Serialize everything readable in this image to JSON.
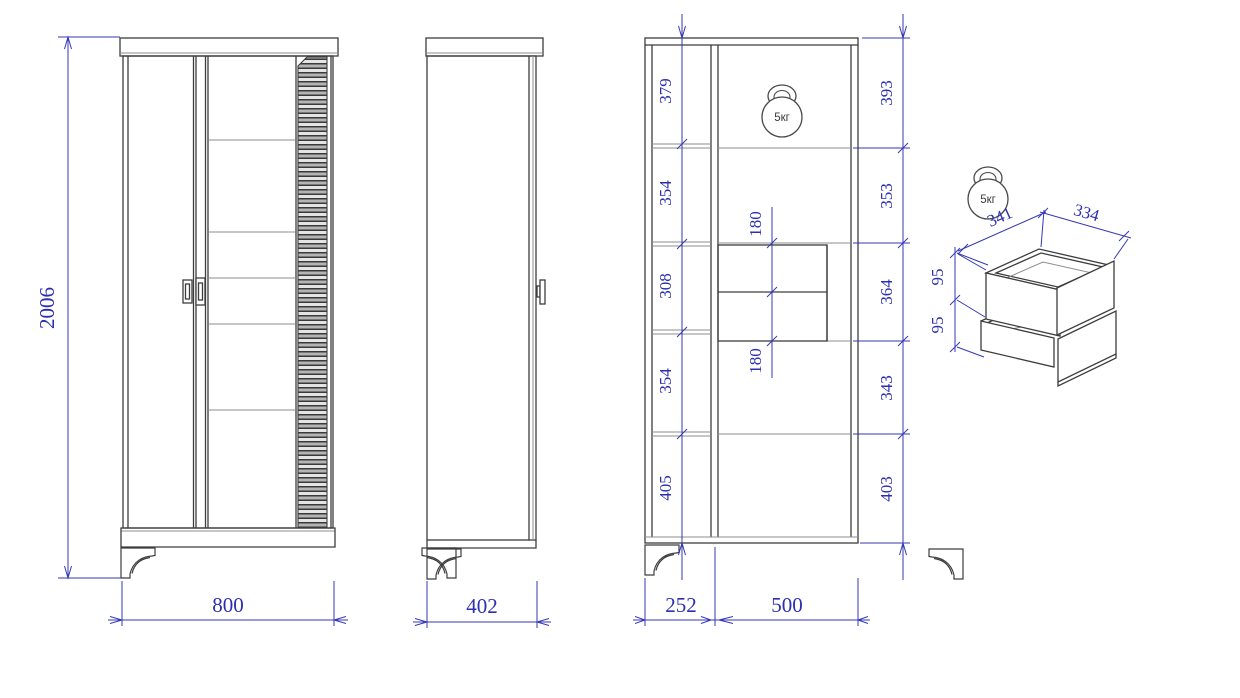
{
  "drawing": {
    "type": "furniture-technical-drawing",
    "colors": {
      "dimension_blue": "#2c30b0",
      "line_dark": "#3d3d3d",
      "line_light": "#8d8d8d"
    }
  },
  "front_view": {
    "height": "2006",
    "width": "800"
  },
  "side_view": {
    "depth": "402"
  },
  "interior_view": {
    "left_column_heights": [
      "379",
      "354",
      "308",
      "354",
      "405"
    ],
    "right_column_heights": [
      "393",
      "353",
      "364",
      "343",
      "403"
    ],
    "drawer_front_heights": [
      "180",
      "180"
    ],
    "section_widths": [
      "252",
      "500"
    ],
    "max_load": "5кг"
  },
  "drawer_unit": {
    "depth": "341",
    "width": "334",
    "drawer_heights": [
      "95",
      "95"
    ],
    "max_load": "5кг"
  }
}
